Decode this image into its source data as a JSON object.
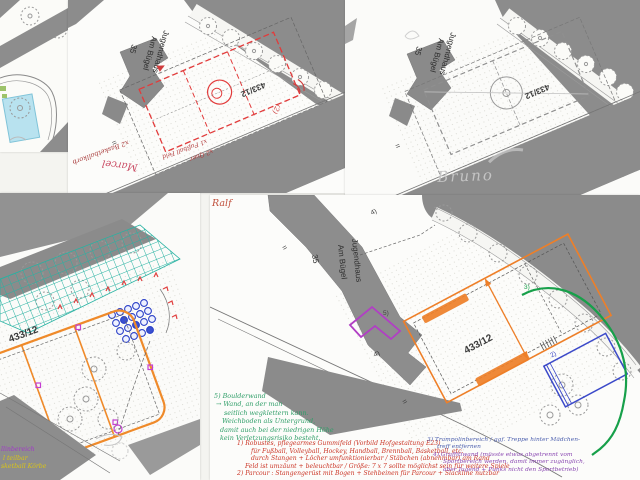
{
  "base_map": {
    "building": "Jugendhaus",
    "street": "Am Bügel",
    "number": "35",
    "parcel": "433/12",
    "equals": "="
  },
  "panel_top_middle": {
    "author": "Marcel",
    "note_basketball": "x2 Basketballkorb",
    "note_fussball": "x1 Fußball Feld",
    "note_quer": "x2 Quer",
    "note_ref": "(2)"
  },
  "panel_top_right": {
    "author": "Bruno"
  },
  "panel_bottom_left": {
    "note_purple": "llinbereich",
    "note_yellow1": "l teilbar",
    "note_yellow2": "sketball Körbe"
  },
  "panel_bottom_right": {
    "author": "Ralf",
    "label_2": "2)",
    "label_3": "3)",
    "label_4": "4)",
    "label_5": "5)",
    "green_note": {
      "lines": [
        "5) Boulderwand",
        "→ Wand, an der man",
        "seitlich wegklettern kann.",
        "Weichboden als Untergrund,",
        "damit auch bei der niedrigen Höhe",
        "kein Verletzungsrisiko besteht."
      ]
    },
    "red_note": {
      "lines": [
        "1) Robustes, pflegearmes Gummifeld (Vorbild Hofgestaltung E23)",
        "für Fußball, Volleyball, Hockey, Handball, Brennball, Basketball, etc.",
        "durch Stangen + Löcher umfunktionierbar / Stäbchen (abnehmbar) am Rand",
        "Feld ist umzäunt + beleuchtbar / Größe: 7 x 7 sollte möglichst sein für weitere Spiele",
        "2) Parcour : Stangengerüst mit Bogen + Stehbeinen für Parcour + Slackline nutzbar"
      ]
    },
    "blue_note": {
      "lines": [
        "3) Trampolinbereich / ggf. Treppe hinter Mädchen-",
        "treff entfernen"
      ]
    },
    "purple_note": {
      "lines": [
        "4) Graffitiwand (müsste etwas abgetrennt vom",
        "Sportbereich werden, damit immer zugänglich,",
        "aber Jugend + Punks nicht den Sportbetrieb)"
      ]
    }
  }
}
